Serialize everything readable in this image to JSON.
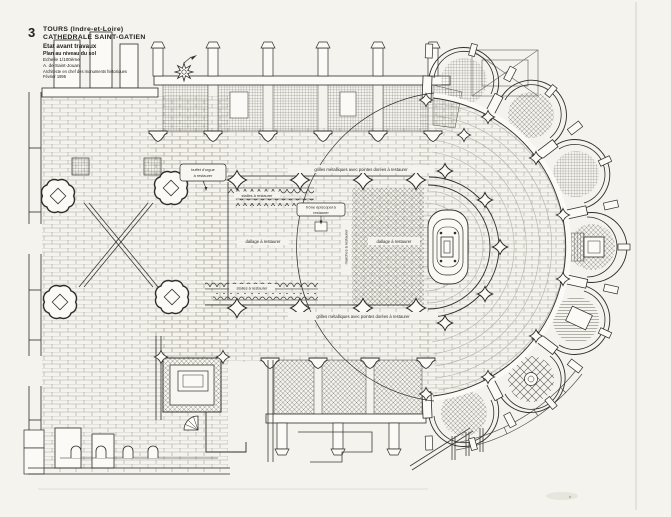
{
  "page": {
    "figure_number": "3",
    "title_block": {
      "lines": [
        "TOURS  (Indre-et-Loire)",
        "CATHEDRALE  SAINT-GATIEN",
        "Etat avant travaux",
        "Plan au niveau du sol",
        "Echelle  1/100ème",
        "A. de Saint-Jouan",
        "Architecte en chef des monuments historiques",
        "Février 1995"
      ]
    },
    "annotations": {
      "organ_line1": "buffet d'orgue",
      "organ_line2": "à restaurer",
      "stalls_top": "stalles à restaurer",
      "stalls_bottom": "stalles à restaurer",
      "grilles_top": "grilles métalliques avec pointes dorées à restaurer",
      "grilles_bottom": "grilles métalliques avec pointes dorées à restaurer",
      "throne_line1": "trône épiscopal à",
      "throne_line2": "restaurer",
      "paving_choir": "dallage à restaurer",
      "paving_sanctuary": "dallage à restaurer",
      "steps": "marches à restaurer"
    },
    "colors": {
      "paper": "#f4f3ee",
      "ink": "#2f2e29",
      "paving_line": "#aaa79b",
      "hatch_line": "#6e6c64"
    }
  }
}
